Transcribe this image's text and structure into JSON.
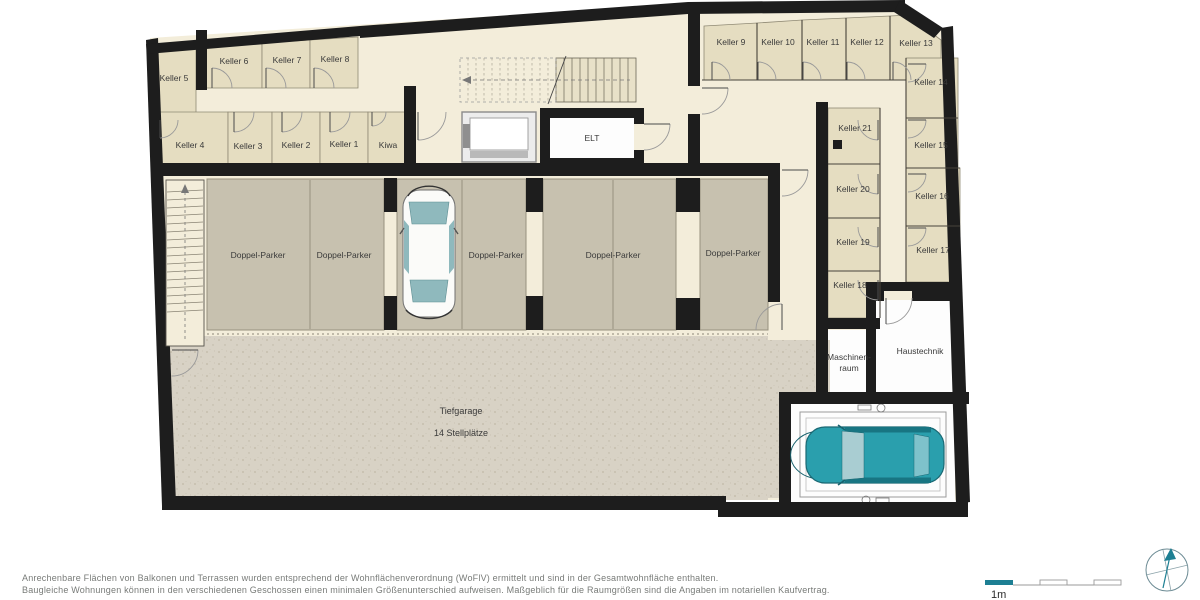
{
  "plan": {
    "rooms": {
      "keller1": "Keller 1",
      "keller2": "Keller 2",
      "keller3": "Keller 3",
      "keller4": "Keller 4",
      "keller5": "Keller 5",
      "keller6": "Keller 6",
      "keller7": "Keller 7",
      "keller8": "Keller 8",
      "keller9": "Keller 9",
      "keller10": "Keller 10",
      "keller11": "Keller 11",
      "keller12": "Keller 12",
      "keller13": "Keller 13",
      "keller14": "Keller 14",
      "keller15": "Keller 15",
      "keller16": "Keller 16",
      "keller17": "Keller 17",
      "keller18": "Keller 18",
      "keller19": "Keller 19",
      "keller20": "Keller 20",
      "keller21": "Keller 21",
      "kiwa": "Kiwa",
      "elt": "ELT",
      "maschinenraum": {
        "line1": "Maschinen-",
        "line2": "raum"
      },
      "haustechnik": "Haustechnik"
    },
    "garage": {
      "title": "Tiefgarage",
      "subtitle": "14 Stellplätze",
      "parking_spots": [
        "Doppel-Parker",
        "Doppel-Parker",
        "Doppel-Parker",
        "Doppel-Parker",
        "Doppel-Parker"
      ]
    }
  },
  "legend": {
    "scale_label": "1m"
  },
  "footer": {
    "line1": "Anrechenbare Flächen von Balkonen und Terrassen wurden entsprechend der Wohnflächenverordnung (WoFlV) ermittelt und sind in der Gesamtwohnfläche enthalten.",
    "line2": "Baugleiche Wohnungen können in den verschiedenen Geschossen einen minimalen Größenunterschied aufweisen. Maßgeblich für die Raumgrößen sind die Angaben im notariellen Kaufvertrag."
  },
  "colors": {
    "wall": "#1d1d1d",
    "cellar_room": "#e5ddc1",
    "corridor": "#f3edda",
    "parking_bay": "#c7c1af",
    "drive_aisle": "#d8d2c5",
    "white_room": "#fdfdfd",
    "car_teal": "#2a9fad",
    "legend_teal": "#1d7f93"
  }
}
